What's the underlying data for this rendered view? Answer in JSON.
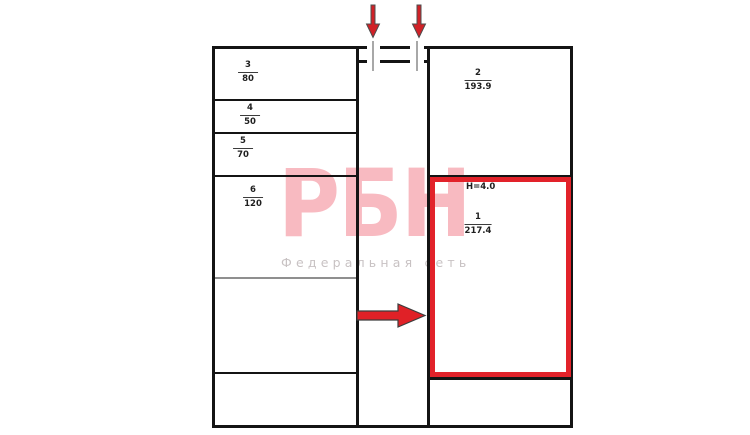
{
  "document": {
    "type": "floor-plan",
    "background": "#ffffff"
  },
  "watermark": {
    "brand": "РБН",
    "subtitle": "Федеральная сеть",
    "brand_color": "#f8bac1",
    "subtitle_color": "#c8c2c3"
  },
  "plan": {
    "wall_color": "#141414",
    "opening_tick_color": "#a8a8a8",
    "rooms": [
      {
        "number": "3",
        "area": "80"
      },
      {
        "number": "4",
        "area": "50"
      },
      {
        "number": "5",
        "area": "70"
      },
      {
        "number": "6",
        "area": "120"
      },
      {
        "number": "2",
        "area": "193.9"
      },
      {
        "number": "1",
        "area": "217.4"
      }
    ],
    "highlight": {
      "room_number": "1",
      "area": "217.4",
      "ceiling_height_label": "H=4.0",
      "outline_color": "#e2222a"
    }
  },
  "annotations": {
    "entrance_arrows_count": 2,
    "direction_arrow": "right",
    "arrow_color": "#d12127"
  }
}
